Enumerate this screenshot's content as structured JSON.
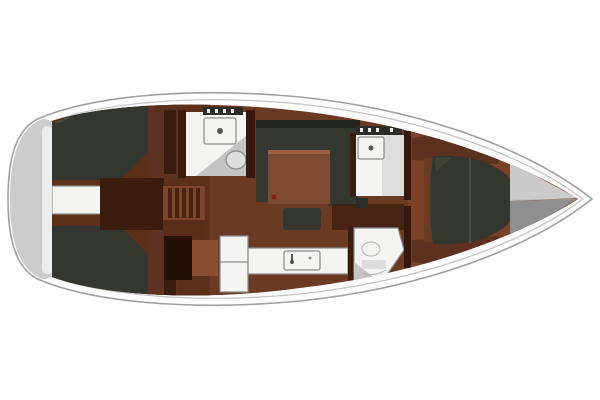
{
  "diagram": {
    "type": "yacht-interior-floor-plan",
    "view": "top-down",
    "orientation": "bow-right, stern-left"
  },
  "colors": {
    "hull_fill": "#fdfdfd",
    "hull_stroke": "#a0a0a0",
    "deck_line": "#c4c4c4",
    "transom": "#cccccc",
    "transom_light": "#ececec",
    "floor": "#6b3a23",
    "floor_aft": "#5b2f1a",
    "floor_fwd": "#7a4227",
    "wall": "#33180b",
    "wood": "#5d3120",
    "wood_dark": "#3a1d0f",
    "wood_light": "#8a4e32",
    "table": "#7c4a31",
    "table_edge": "#9a5f41",
    "berth": "#343730",
    "berth_dark": "#23251f",
    "berth_light": "#4a4d42",
    "white_fixture": "#f4f4f3",
    "fixture_stroke": "#8a8a8a",
    "gray_panel": "#c4c4c4",
    "panel_light": "#dddddd",
    "bow_locker_upper": "#cbcbcb",
    "bow_locker_lower": "#8f8f8f",
    "hatch_bar": "#2b2b28",
    "hatch_tick": "#ededed",
    "step": "#7c452c",
    "step_rung": "#442312",
    "landing": "#5a2d1a",
    "dark_cabinet": "#241209",
    "seat": "#8a4f33",
    "accent_red": "#8a1a10",
    "steel": "#555555"
  },
  "regions": {
    "hull": "Sailboat hull, bow to the right, stern to the left",
    "transom": "Transom platform",
    "aft_port_cabin": "Aft port cabin double berth",
    "aft_starboard_cabin": "Aft starboard cabin double berth",
    "engine_walkway": "Engine access walkway between aft cabins",
    "companionway": "Companionway steps",
    "aft_head": "Aft head with toilet and shower",
    "salon": "Salon with U-shaped settee, table and stool",
    "galley": "Galley with counter, sink and fridge",
    "nav_seat": "Navigation seat",
    "forward_head": "Forward head with toilet",
    "forward_shower": "Forward shower compartment",
    "forward_cabin": "Forward cabin with island berth",
    "bow_locker": "Bow anchor locker"
  }
}
